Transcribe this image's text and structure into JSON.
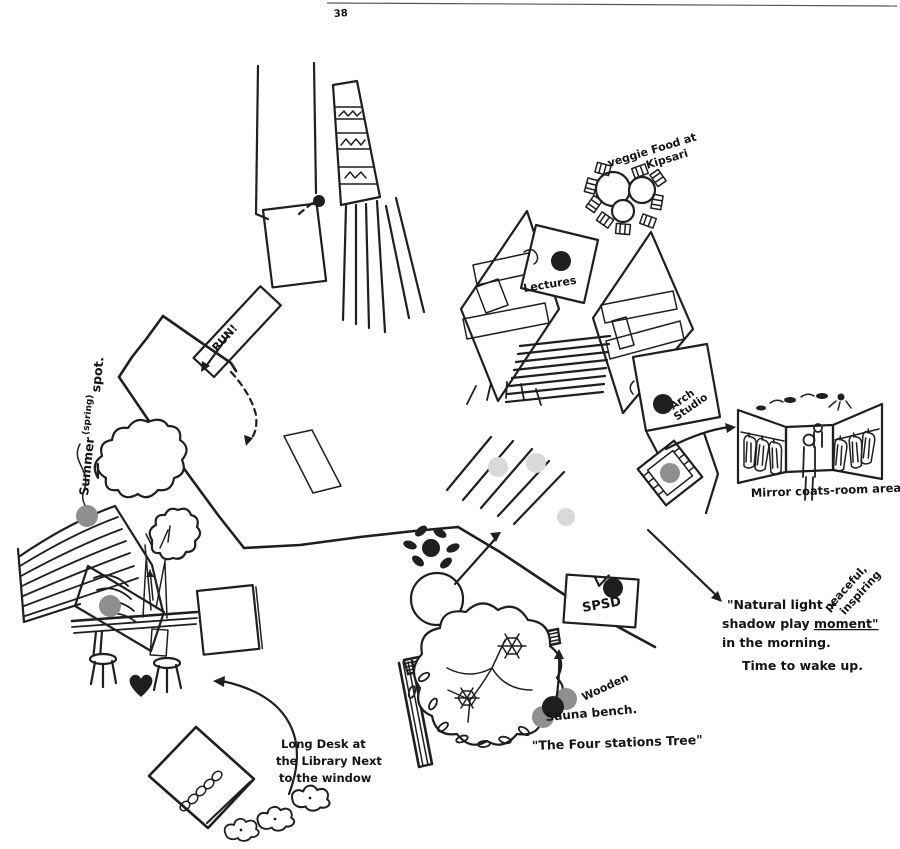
{
  "page": {
    "number": "38"
  },
  "colors": {
    "ink": "#1f1f1f",
    "marker_gray": "#8f8f8f",
    "light_gray": "#d9d9d9",
    "paper": "#ffffff"
  },
  "labels": {
    "run": "RUN!",
    "kipsari": {
      "line1": "veggie Food at",
      "line2": "Kipsari"
    },
    "lectures": "Lectures",
    "arch_studio": {
      "line1": "Arch",
      "line2": "Studio"
    },
    "mirror_caption": "Mirror coats-room area",
    "spsd": "SPSD",
    "natural_light": {
      "line1": "\"Natural light +",
      "line2_pre": "shadow play ",
      "line2_underlined": "moment\"",
      "line3": "in the morning.",
      "line4": "Time to wake up."
    },
    "mood": {
      "line1": "peaceful,",
      "line2": "inspiring"
    },
    "summer": {
      "word1": "Summer",
      "note": "(spring)",
      "word2": "spot."
    },
    "long_desk": {
      "line1": "Long Desk at",
      "line2": "the Library Next",
      "line3": "to the window"
    },
    "tree": {
      "material": "Wooden",
      "bench": "Sauna bench.",
      "title": "\"The Four stations Tree\""
    }
  }
}
